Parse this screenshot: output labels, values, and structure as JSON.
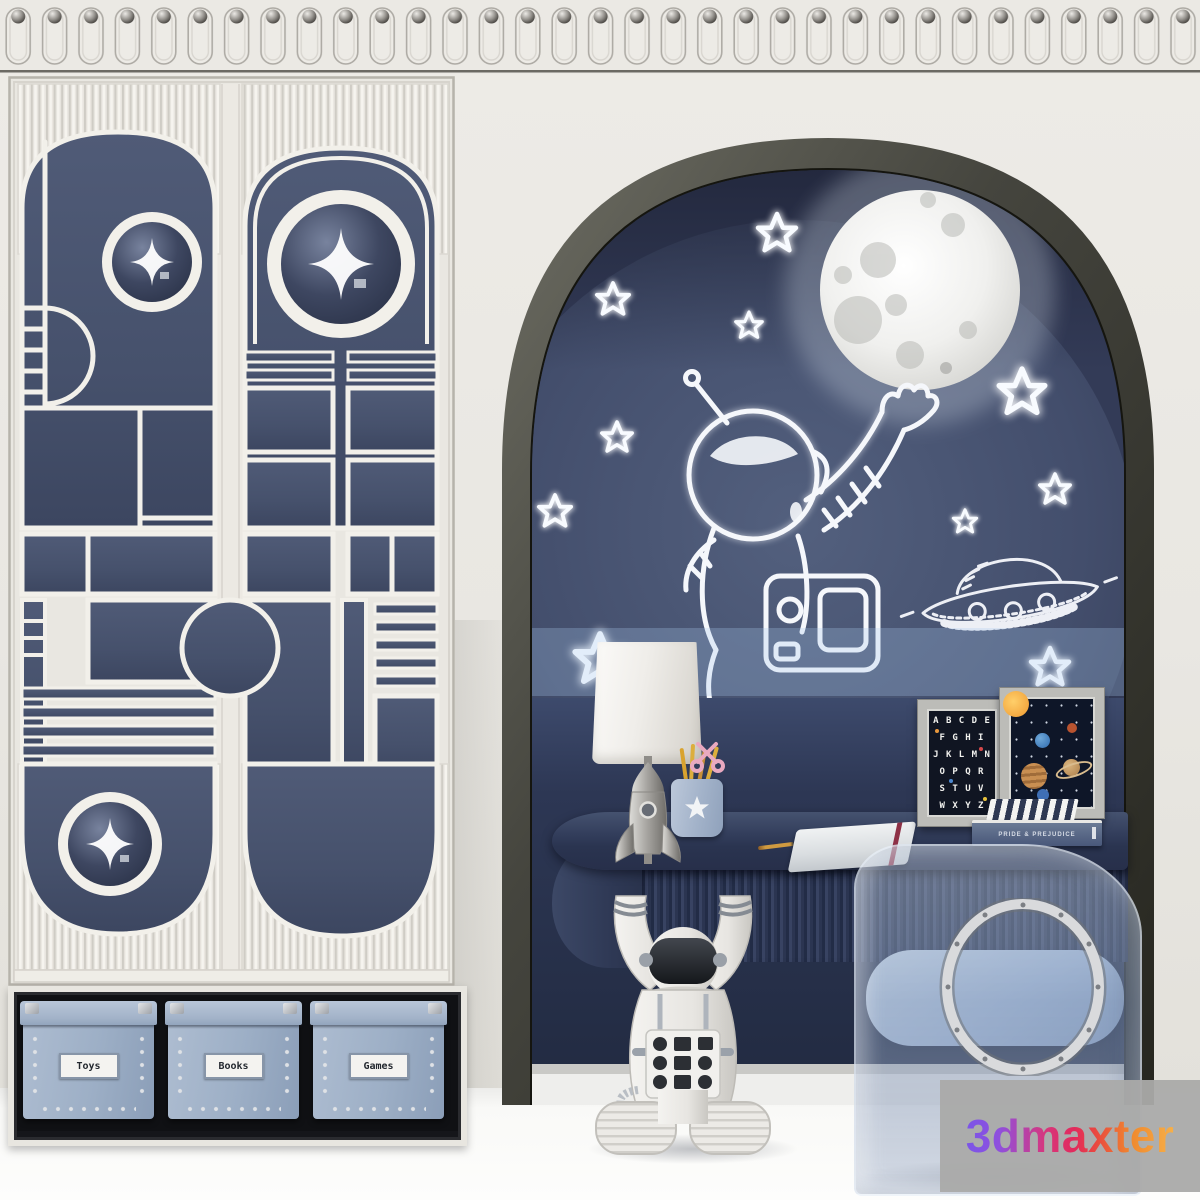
{
  "watermark": {
    "text": "3dmaxter",
    "background": "#aaaaa9",
    "gradient": [
      "#7b55e8",
      "#e22a5c",
      "#f6b04a"
    ]
  },
  "storage_shelf": {
    "boxes": [
      {
        "label": "Toys"
      },
      {
        "label": "Books"
      },
      {
        "label": "Games"
      }
    ]
  },
  "desk_items": {
    "alphabet_poster": {
      "rows": [
        "A B C D E",
        "F G H I",
        "J K L M N",
        "O P Q R",
        "S T U V",
        "W X Y Z"
      ]
    },
    "book": {
      "spine": "PRIDE & PREJUDICE"
    }
  },
  "mural": {
    "elements": [
      "moon",
      "stars",
      "astronaut",
      "ufo"
    ],
    "glow_color": "#cfe4f8"
  },
  "colors": {
    "wall_cream": "#eae8e3",
    "panel_navy": "#46526d",
    "mural_dark": "#2e3650",
    "desk_navy": "#323d59",
    "box_blue": "#9fb0c8",
    "arch_frame": "#3a3a34",
    "floor": "#fdfdfc"
  }
}
